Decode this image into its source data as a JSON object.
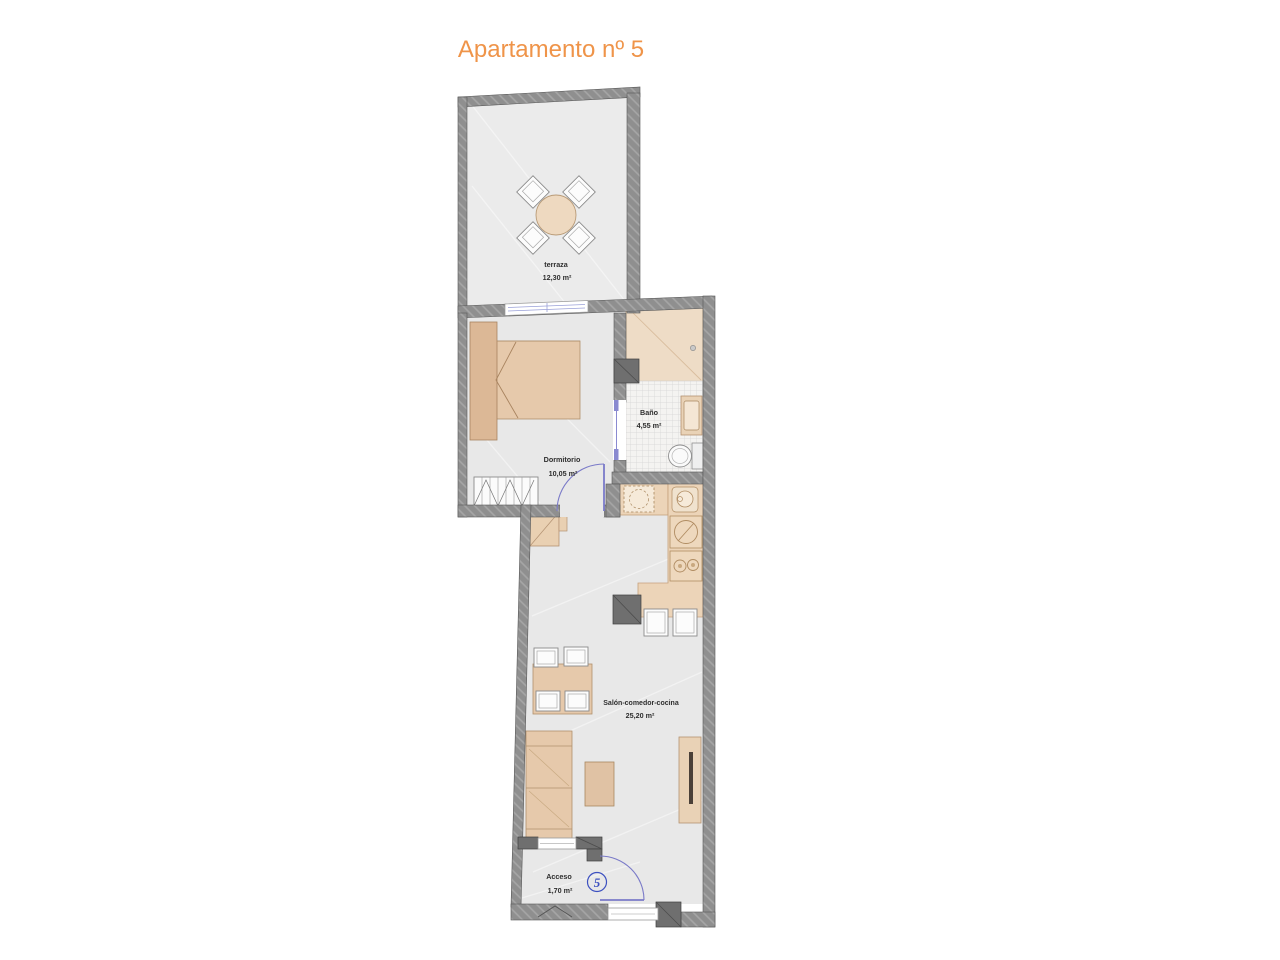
{
  "title": "Apartamento nº 5",
  "unit": {
    "badge": "5"
  },
  "rooms": {
    "terraza": {
      "name": "terraza",
      "area": "12,30 m²"
    },
    "dormitorio": {
      "name": "Dormitorio",
      "area": "10,05 m²"
    },
    "bano": {
      "name": "Baño",
      "area": "4,55 m²"
    },
    "salon": {
      "name": "Salón-comedor-cocina",
      "area": "25,20 m²"
    },
    "acceso": {
      "name": "Acceso",
      "area": "1,70 m²"
    }
  },
  "colors": {
    "title_accent": "#ef9449",
    "wall_gray": "#8f8f8f",
    "pillar_gray": "#6f6f6f",
    "floor_gray": "#e8e8e8",
    "furniture_beige": "#e6c9ab",
    "counter_beige": "#ecd4b8",
    "door_blue": "#7a7ac8",
    "badge_blue": "#3c50c0"
  }
}
